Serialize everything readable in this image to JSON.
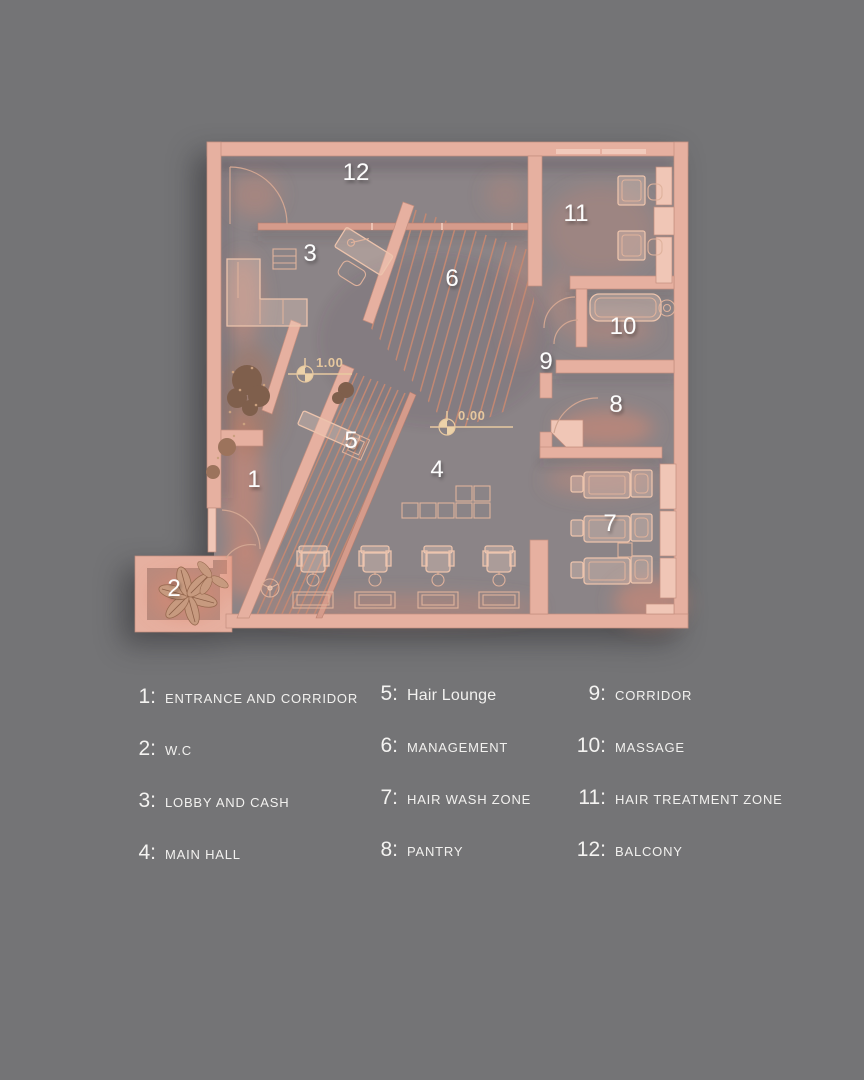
{
  "background_color": "#747476",
  "plan": {
    "numbers": [
      "1",
      "2",
      "3",
      "4",
      "5",
      "6",
      "7",
      "8",
      "9",
      "10",
      "11",
      "12"
    ],
    "elevation_markers": [
      "1.00",
      "0.00"
    ],
    "colors": {
      "wall": "#e6b0a0",
      "wall_light": "#f0c6b6",
      "floor": "#8b8487",
      "background": "#747476",
      "number_text": "#fdfdfd",
      "elevation_text": "#e6c79e"
    }
  },
  "legend": {
    "columns": [
      {
        "items": [
          {
            "number": "1:",
            "label": "ENTRANCE AND CORRIDOR"
          },
          {
            "number": "2:",
            "label": "W.C"
          },
          {
            "number": "3:",
            "label": "LOBBY AND CASH"
          },
          {
            "number": "4:",
            "label": "MAIN HALL"
          }
        ]
      },
      {
        "items": [
          {
            "number": "5:",
            "label": "Hair Lounge"
          },
          {
            "number": "6:",
            "label": "MANAGEMENT"
          },
          {
            "number": "7:",
            "label": "HAIR WASH ZONE"
          },
          {
            "number": "8:",
            "label": "PANTRY"
          }
        ]
      },
      {
        "items": [
          {
            "number": "9:",
            "label": "CORRIDOR"
          },
          {
            "number": "10:",
            "label": "MASSAGE"
          },
          {
            "number": "11:",
            "label": "HAIR TREATMENT ZONE"
          },
          {
            "number": "12:",
            "label": "BALCONY"
          }
        ]
      }
    ]
  }
}
